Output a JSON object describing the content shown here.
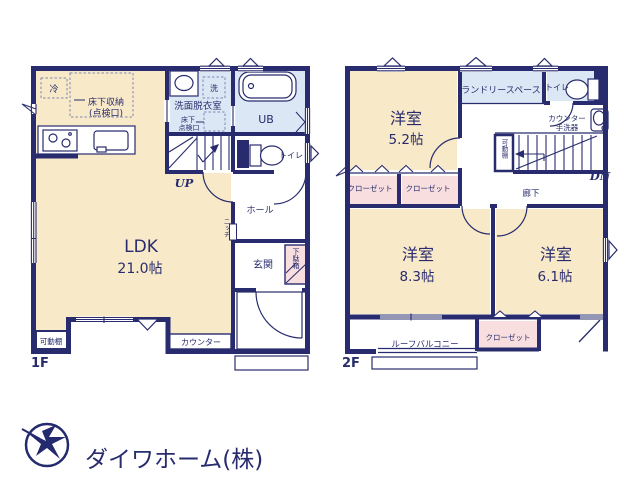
{
  "colors": {
    "wall": "#282c6e",
    "room_cream": "#f8e9c8",
    "water_blue": "#dbe7f4",
    "closet_pink": "#f8dede",
    "logo_text": "#c9cdd9"
  },
  "f1": {
    "floor_label": "1F",
    "ldk": {
      "name": "LDK",
      "area": "21.0帖"
    },
    "kitchen": {
      "fridge": "冷",
      "underfloor_storage": "床下収納",
      "inspection_hatch": "(点検口)"
    },
    "washroom": {
      "name": "洗面脱衣室",
      "washer": "洗",
      "underfloor_line1": "床下",
      "underfloor_line2": "点検口"
    },
    "bath": {
      "name": "UB"
    },
    "toilet": {
      "name": "トイレ"
    },
    "hall": {
      "name": "ホール"
    },
    "entrance": {
      "name": "玄関",
      "shoe_box": "下駄箱"
    },
    "niche": "ニッチ",
    "stairs_up": "UP",
    "counter": "カウンター",
    "shelf": "可動棚"
  },
  "f2": {
    "floor_label": "2F",
    "bedroom1": {
      "name": "洋室",
      "area": "5.2帖"
    },
    "bedroom2": {
      "name": "洋室",
      "area": "8.3帖"
    },
    "bedroom3": {
      "name": "洋室",
      "area": "6.1帖"
    },
    "laundry": "ランドリースペース",
    "toilet": "トイレ",
    "basin_line1": "カウンター",
    "basin_line2": "手洗器",
    "shelf": "可動棚",
    "corridor": "廊下",
    "stairs_down": "DN",
    "closets": [
      "クローゼット",
      "クローゼット",
      "クローゼット"
    ],
    "balcony": "ルーフバルコニー"
  },
  "logo": {
    "company": "ダイワホーム(株)"
  }
}
